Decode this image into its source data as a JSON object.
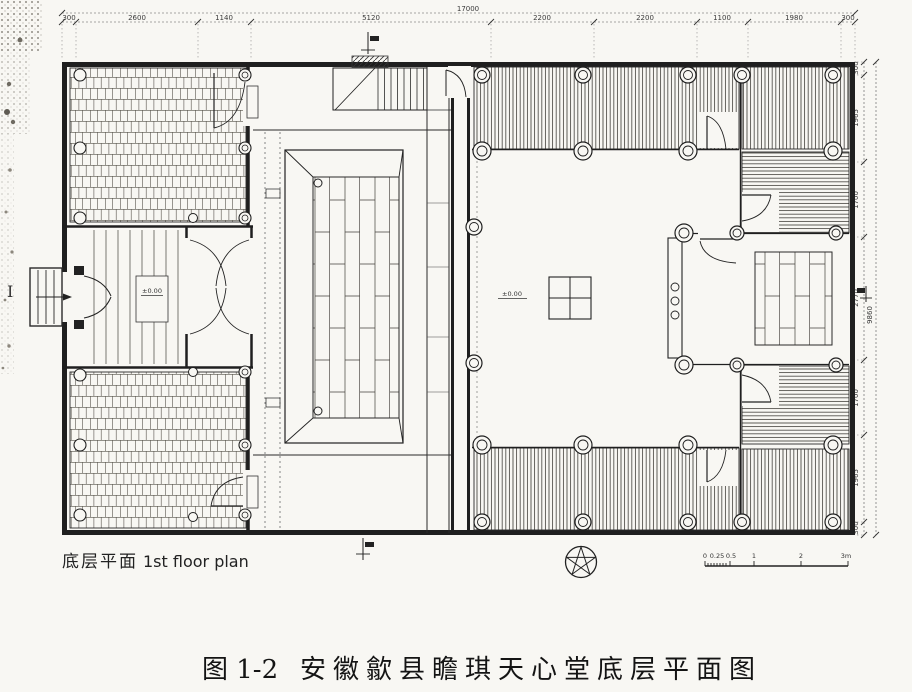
{
  "figure": {
    "caption_prefix": "图 1-2",
    "caption_title": "安徽歙县瞻琪天心堂底层平面图",
    "plan_label_zh": "底层平面",
    "plan_label_en": "1st floor plan"
  },
  "dimensions": {
    "top": {
      "total": "17000",
      "segments": [
        "300",
        "2600",
        "1140",
        "5120",
        "2200",
        "2200",
        "1100",
        "1980",
        "300"
      ]
    },
    "right": {
      "total": "9860",
      "segments": [
        "300",
        "1965",
        "1700",
        "2770",
        "1700",
        "1965",
        "300"
      ]
    }
  },
  "annotations": {
    "elevation_courtyard": "±0.00",
    "elevation_entry_hall": "±0.00",
    "section_label_left": "I"
  },
  "scale_bar": {
    "labels": [
      "0",
      "0.25",
      "0.5",
      "1",
      "2",
      "3m"
    ]
  },
  "icons": {
    "north_arrow": "north-arrow-compass",
    "section_cut_top": "section-cut-flag",
    "section_cut_bottom": "section-cut-flag",
    "section_cut_right": "section-cut-flag"
  },
  "colors": {
    "paper": "#f8f7f3",
    "ink": "#222222"
  }
}
